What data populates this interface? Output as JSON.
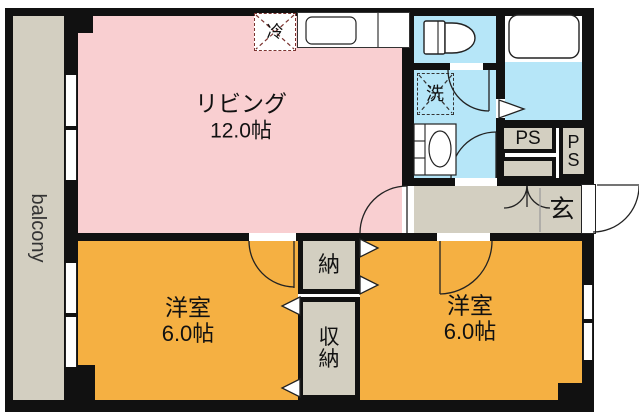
{
  "colors": {
    "living_pink": "#f9cfd1",
    "bedroom_orange": "#f5b042",
    "water_cyan": "#b6e6f8",
    "balcony_tan": "#d3cfc1",
    "wall_black": "#111111",
    "fridge_dash_red": "#7b3430"
  },
  "rooms": {
    "balcony": {
      "label": "balcony"
    },
    "living": {
      "label": "リビング",
      "size": "12.0帖"
    },
    "bedroom_left": {
      "label": "洋室",
      "size": "6.0帖"
    },
    "bedroom_right": {
      "label": "洋室",
      "size": "6.0帖"
    },
    "storage": {
      "label": "納"
    },
    "closet": {
      "label": "収納"
    },
    "entrance": {
      "label": "玄"
    },
    "pipe_space_1": {
      "label": "PS"
    },
    "pipe_space_2": {
      "label": "PS"
    }
  },
  "fixtures": {
    "refrigerator": {
      "label": "冷"
    },
    "washing_machine": {
      "label": "洗"
    }
  }
}
